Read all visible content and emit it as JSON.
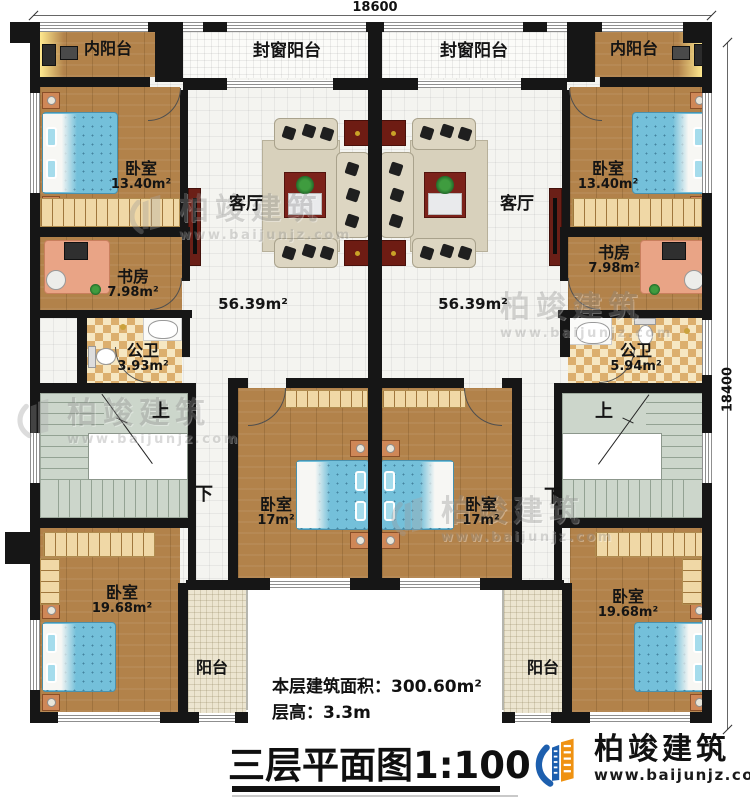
{
  "dimensions": {
    "width_mm": "18600",
    "height_mm": "18400"
  },
  "rooms": {
    "inner_balcony_left": "内阳台",
    "sealed_balcony_left": "封窗阳台",
    "sealed_balcony_right": "封窗阳台",
    "inner_balcony_right": "内阳台",
    "bedroom13_left": {
      "label": "卧室",
      "area": "13.40m²"
    },
    "bedroom13_right": {
      "label": "卧室",
      "area": "13.40m²"
    },
    "living_left": {
      "label": "客厅",
      "area": "56.39m²"
    },
    "living_right": {
      "label": "客厅",
      "area": "56.39m²"
    },
    "study_left": {
      "label": "书房",
      "area": "7.98m²"
    },
    "study_right": {
      "label": "书房",
      "area": "7.98m²"
    },
    "bath_left": {
      "label": "公卫",
      "area": "3.93m²"
    },
    "bath_right": {
      "label": "公卫",
      "area": "5.94m²"
    },
    "bedroom17_left": {
      "label": "卧室",
      "area": "17m²"
    },
    "bedroom17_right": {
      "label": "卧室",
      "area": "17m²"
    },
    "bedroom19_left": {
      "label": "卧室",
      "area": "19.68m²"
    },
    "bedroom19_right": {
      "label": "卧室",
      "area": "19.68m²"
    },
    "balcony_left": "阳台",
    "balcony_right": "阳台"
  },
  "stairs": {
    "up": "上",
    "down": "下"
  },
  "stats": {
    "line1": "本层建筑面积：300.60m²",
    "line2": "层高：3.3m"
  },
  "title": "三层平面图1:100",
  "watermark": {
    "brand": "柏竣建筑",
    "url": "www.baijunjz.com"
  },
  "logo": {
    "brand": "柏竣建筑",
    "url": "www.baijunjz.com"
  },
  "colors": {
    "wall": "#161616",
    "wood_floor": "#b2824a",
    "checker_tile": "#dcaf6e",
    "stair_floor": "#ccd6cb",
    "bed": "#74c0da",
    "accent_red": "#7c221a",
    "logo_blue": "#1d5fae",
    "logo_orange": "#ef9212"
  }
}
